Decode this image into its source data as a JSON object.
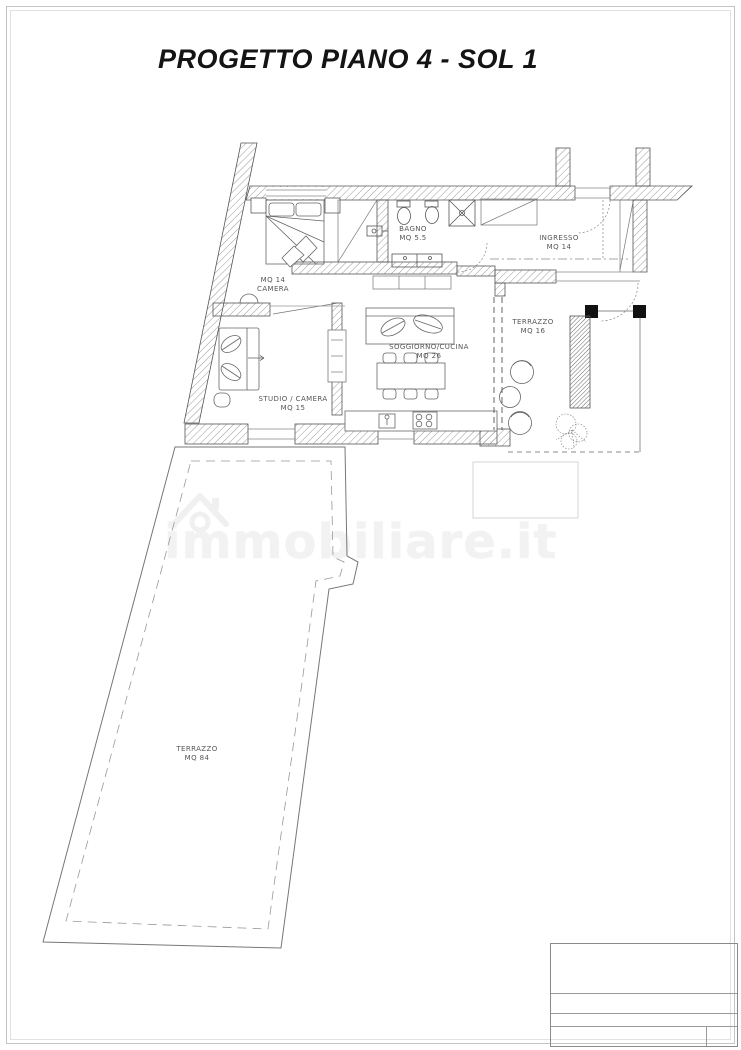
{
  "page": {
    "title": "PROGETTO PIANO 4 - SOL 1"
  },
  "watermark": {
    "text": "immobiliare.it",
    "icon": "house-icon"
  },
  "rooms": {
    "camera": {
      "line1": "MQ 14",
      "line2": "CAMERA"
    },
    "bagno": {
      "line1": "BAGNO",
      "line2": "MQ 5.5"
    },
    "ingresso": {
      "line1": "INGRESSO",
      "line2": "MQ 14"
    },
    "terrazzo_piccolo": {
      "line1": "TERRAZZO",
      "line2": "MQ 16"
    },
    "soggiorno": {
      "line1": "SOGGIORNO/CUCINA",
      "line2": "MQ 26"
    },
    "studio": {
      "line1": "STUDIO / CAMERA",
      "line2": "MQ 15"
    },
    "terrazzo_grande": {
      "line1": "TERRAZZO",
      "line2": "MQ 84"
    }
  }
}
